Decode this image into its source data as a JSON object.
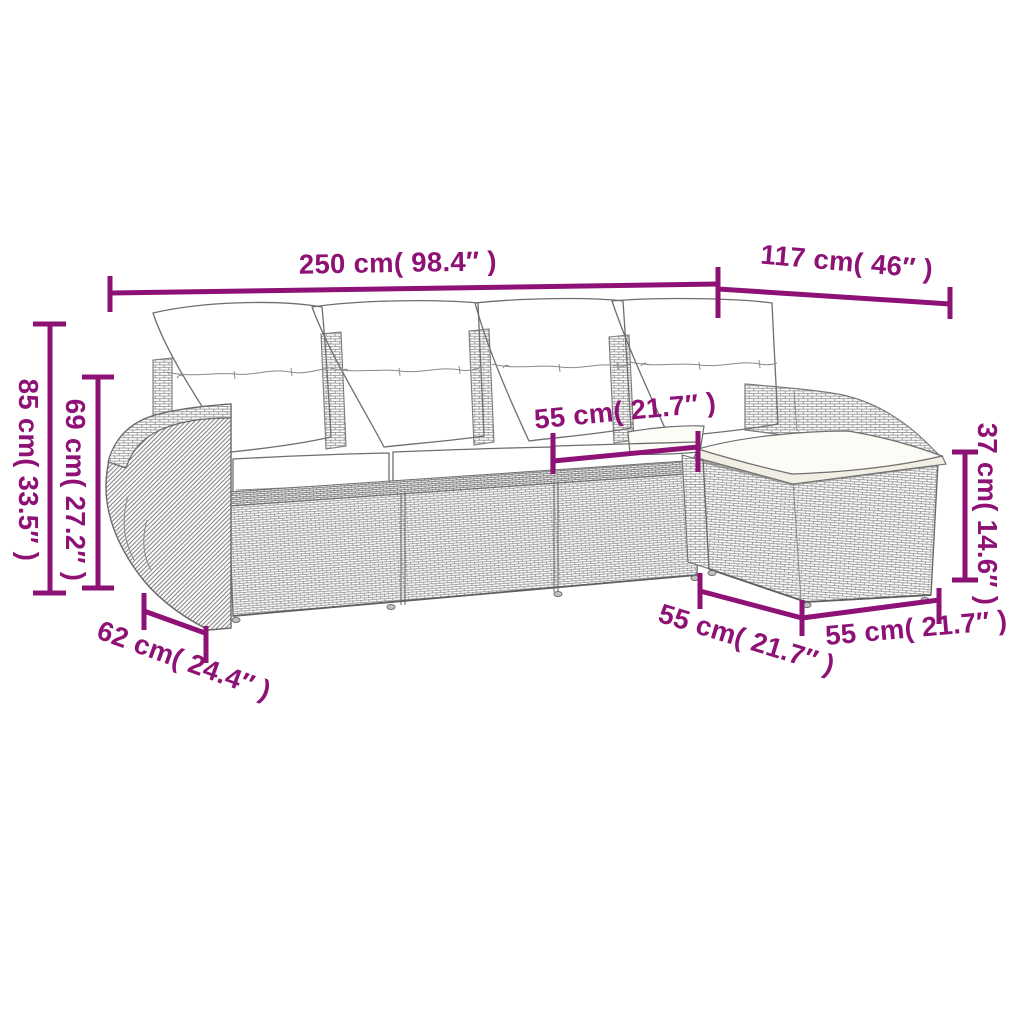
{
  "title": "Corner sofa set with ottoman — dimension diagram",
  "accent_color": "#8E1276",
  "line_art_color": "#7a7a7a",
  "illustration": {
    "subject": "poly-rattan 4-seat corner sofa with left round armrest, four back cushions, seat cushions and ottoman footstool",
    "back_cushion_count": 4
  },
  "dimensions": {
    "overall_width": "250 cm( 98.4″ )",
    "chaise_total_depth": "117 cm( 46″ )",
    "overall_height": "85 cm( 33.5″ )",
    "backrest_height": "69 cm( 27.2″ )",
    "seat_width": "55 cm( 21.7″ )",
    "ottoman_height": "37 cm( 14.6″ )",
    "armrest_depth": "62 cm( 24.4″ )",
    "ottoman_width": "55 cm( 21.7″ )",
    "ottoman_depth": "55 cm( 21.7″ )"
  }
}
